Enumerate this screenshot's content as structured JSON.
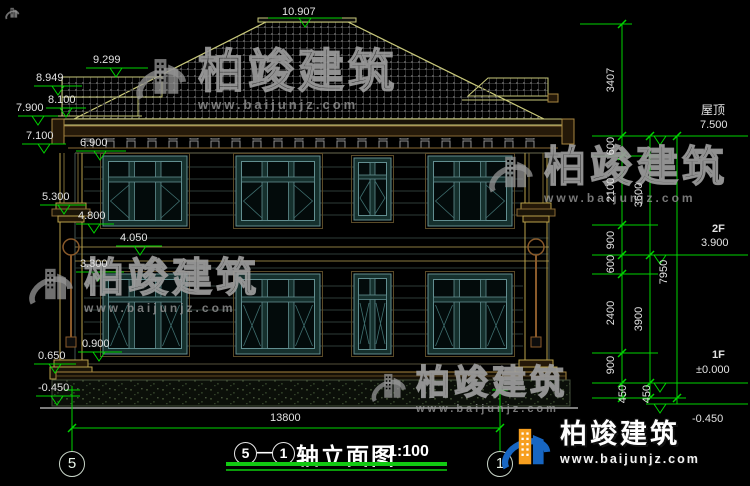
{
  "watermark": {
    "name": "柏竣建筑",
    "url": "www.baijunjz.com"
  },
  "title": {
    "axis_start": "5",
    "axis_end": "1",
    "name": "轴立面图",
    "scale": "1:100"
  },
  "grid": {
    "left": "5",
    "right": "1"
  },
  "levels_left": [
    "10.907",
    "9.299",
    "8.949",
    "8.100",
    "7.900",
    "7.100",
    "6.900",
    "5.300",
    "4.800",
    "4.050",
    "3.300",
    "0.900",
    "0.650",
    "-0.450"
  ],
  "levels_right": [
    {
      "label": "屋顶",
      "value": "7.500"
    },
    {
      "label": "2F",
      "value": "3.900"
    },
    {
      "label": "1F",
      "value": "±0.000"
    },
    {
      "label": "",
      "value": "-0.450"
    }
  ],
  "dims": {
    "overall_width": "13800",
    "right_inner": [
      "3407",
      "600",
      "2100",
      "900",
      "600",
      "2400",
      "900",
      "450"
    ],
    "right_middle": [
      "3600",
      "3900",
      "450"
    ],
    "right_outer": [
      "7950"
    ]
  },
  "colors": {
    "background": "#000000",
    "dim_green": "#00d400",
    "label_text": "#e2e2e2",
    "roof_line": "#c9c97a",
    "trim_tan": "#a8863f",
    "window_teal": "#628e90",
    "logo_blue": "#1766c2",
    "logo_orange": "#f79f1f"
  }
}
